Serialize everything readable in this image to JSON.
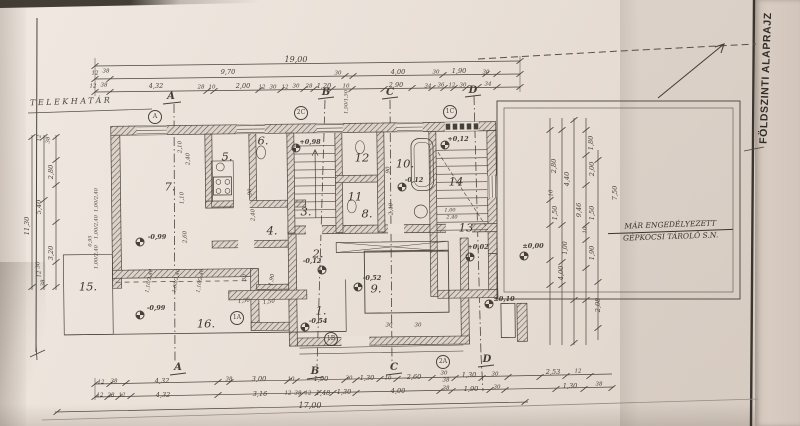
{
  "meta": {
    "sheet_title": "FÖLDSZINTI ALAPRAJZ"
  },
  "site": {
    "boundary_label": "TELEKHATÁR",
    "garage_note_line1": "MÁR ENGEDÉLYEZETT",
    "garage_note_line2": "GÉPKOCSI TÁROLÓ S.N."
  },
  "colors": {
    "paper": "#eae1d9",
    "ink": "#4a443e",
    "binder_strip": "#d8ccc2"
  },
  "rooms": [
    {
      "v": "1.",
      "x": 321,
      "y": 311
    },
    {
      "v": "2.",
      "x": 318,
      "y": 254
    },
    {
      "v": "3.",
      "x": 306,
      "y": 212
    },
    {
      "v": "4.",
      "x": 272,
      "y": 231
    },
    {
      "v": "5.",
      "x": 227,
      "y": 157
    },
    {
      "v": "6.",
      "x": 263,
      "y": 141
    },
    {
      "v": "7.",
      "x": 170,
      "y": 187
    },
    {
      "v": "8.",
      "x": 367,
      "y": 214
    },
    {
      "v": "9.",
      "x": 376,
      "y": 289
    },
    {
      "v": "10.",
      "x": 405,
      "y": 164
    },
    {
      "v": "11",
      "x": 355,
      "y": 197
    },
    {
      "v": "12",
      "x": 362,
      "y": 158
    },
    {
      "v": "13",
      "x": 466,
      "y": 228
    },
    {
      "v": "14",
      "x": 456,
      "y": 182
    },
    {
      "v": "15.",
      "x": 88,
      "y": 287
    },
    {
      "v": "16.",
      "x": 206,
      "y": 324
    }
  ],
  "dimensions": [
    {
      "v": "19,00",
      "x": 296,
      "y": 60,
      "s": 8
    },
    {
      "v": "9,70",
      "x": 228,
      "y": 72
    },
    {
      "v": "4,00",
      "x": 398,
      "y": 72
    },
    {
      "v": "1,90",
      "x": 459,
      "y": 71
    },
    {
      "v": "30",
      "x": 338,
      "y": 74,
      "s": 5.5
    },
    {
      "v": "30",
      "x": 436,
      "y": 73,
      "s": 5.5
    },
    {
      "v": "30",
      "x": 486,
      "y": 73,
      "s": 5.5
    },
    {
      "v": "12",
      "x": 95,
      "y": 74,
      "s": 5.5
    },
    {
      "v": "38",
      "x": 106,
      "y": 72,
      "s": 5.5
    },
    {
      "v": "4,32",
      "x": 156,
      "y": 86
    },
    {
      "v": "28",
      "x": 201,
      "y": 88,
      "s": 5.5
    },
    {
      "v": "10",
      "x": 212,
      "y": 88,
      "s": 5.5
    },
    {
      "v": "2,00",
      "x": 243,
      "y": 86
    },
    {
      "v": "12",
      "x": 262,
      "y": 88,
      "s": 5.5
    },
    {
      "v": "30",
      "x": 273,
      "y": 88,
      "s": 5.5
    },
    {
      "v": "12",
      "x": 285,
      "y": 88,
      "s": 5.5
    },
    {
      "v": "30",
      "x": 296,
      "y": 87,
      "s": 5.5
    },
    {
      "v": "28",
      "x": 309,
      "y": 87,
      "s": 5.5
    },
    {
      "v": "1,20",
      "x": 324,
      "y": 86
    },
    {
      "v": "10",
      "x": 346,
      "y": 87,
      "s": 5.5
    },
    {
      "v": "2,90",
      "x": 396,
      "y": 85
    },
    {
      "v": "34",
      "x": 428,
      "y": 87,
      "s": 5.5
    },
    {
      "v": "36",
      "x": 441,
      "y": 86,
      "s": 5.5
    },
    {
      "v": "12",
      "x": 452,
      "y": 86,
      "s": 5.5
    },
    {
      "v": "30",
      "x": 463,
      "y": 86,
      "s": 5.5
    },
    {
      "v": "34",
      "x": 488,
      "y": 85,
      "s": 5.5
    },
    {
      "v": "12",
      "x": 93,
      "y": 87,
      "s": 5.5
    },
    {
      "v": "38",
      "x": 104,
      "y": 86,
      "s": 5.5
    },
    {
      "v": "11,30",
      "x": 27,
      "y": 226,
      "r": -90
    },
    {
      "v": "5,40",
      "x": 39,
      "y": 207,
      "r": -90
    },
    {
      "v": "2,80",
      "x": 51,
      "y": 172,
      "r": -90
    },
    {
      "v": "3,20",
      "x": 51,
      "y": 253,
      "r": -90
    },
    {
      "v": "12",
      "x": 40,
      "y": 138,
      "r": -90,
      "s": 5.5
    },
    {
      "v": "38",
      "x": 49,
      "y": 140,
      "r": -90,
      "s": 5.5
    },
    {
      "v": "30",
      "x": 39,
      "y": 265,
      "r": -90,
      "s": 5.5
    },
    {
      "v": "12",
      "x": 40,
      "y": 274,
      "r": -90,
      "s": 5.5
    },
    {
      "v": "38",
      "x": 44,
      "y": 283,
      "r": -90,
      "s": 5.5
    },
    {
      "v": "1,00/2,40",
      "x": 97,
      "y": 200,
      "r": -90,
      "s": 5
    },
    {
      "v": "1,00/2,40",
      "x": 97,
      "y": 227,
      "r": -90,
      "s": 5
    },
    {
      "v": "0,95",
      "x": 91,
      "y": 241,
      "r": -90,
      "s": 5
    },
    {
      "v": "1,00/2,40",
      "x": 97,
      "y": 257,
      "r": -90,
      "s": 5
    },
    {
      "v": "1,80",
      "x": 591,
      "y": 143,
      "r": -90
    },
    {
      "v": "2,80",
      "x": 554,
      "y": 166,
      "r": -90
    },
    {
      "v": "4,40",
      "x": 567,
      "y": 179,
      "r": -90
    },
    {
      "v": "2,00",
      "x": 592,
      "y": 169,
      "r": -90
    },
    {
      "v": "10",
      "x": 552,
      "y": 193,
      "r": -90,
      "s": 5.5
    },
    {
      "v": "1,50",
      "x": 555,
      "y": 213,
      "r": -90
    },
    {
      "v": "9,46",
      "x": 579,
      "y": 210,
      "r": -90
    },
    {
      "v": "1,50",
      "x": 592,
      "y": 213,
      "r": -90
    },
    {
      "v": "7,50",
      "x": 615,
      "y": 193,
      "r": -90
    },
    {
      "v": "1,90",
      "x": 592,
      "y": 253,
      "r": -90
    },
    {
      "v": "1,00",
      "x": 566,
      "y": 248,
      "r": -90,
      "s": 6
    },
    {
      "v": "4,00",
      "x": 561,
      "y": 273,
      "r": -90
    },
    {
      "v": "2,08",
      "x": 598,
      "y": 305,
      "r": -90
    },
    {
      "v": "10",
      "x": 586,
      "y": 230,
      "r": -90,
      "s": 5.5
    },
    {
      "v": "12",
      "x": 101,
      "y": 383,
      "s": 5.5
    },
    {
      "v": "38",
      "x": 114,
      "y": 382,
      "s": 5.5
    },
    {
      "v": "4,32",
      "x": 162,
      "y": 381
    },
    {
      "v": "38",
      "x": 229,
      "y": 380,
      "s": 5.5
    },
    {
      "v": "3,00",
      "x": 259,
      "y": 379
    },
    {
      "v": "10",
      "x": 291,
      "y": 380,
      "s": 5.5
    },
    {
      "v": "1,90",
      "x": 321,
      "y": 379
    },
    {
      "v": "30",
      "x": 349,
      "y": 379,
      "s": 5.5
    },
    {
      "v": "1,30",
      "x": 367,
      "y": 378
    },
    {
      "v": "10",
      "x": 388,
      "y": 379,
      "s": 5.5
    },
    {
      "v": "2,60",
      "x": 414,
      "y": 377
    },
    {
      "v": "30",
      "x": 444,
      "y": 374,
      "s": 5.5
    },
    {
      "v": "38",
      "x": 446,
      "y": 381,
      "s": 5.5
    },
    {
      "v": "1,30",
      "x": 469,
      "y": 375
    },
    {
      "v": "30",
      "x": 495,
      "y": 375,
      "s": 5.5
    },
    {
      "v": "2,53",
      "x": 553,
      "y": 372
    },
    {
      "v": "12",
      "x": 578,
      "y": 372,
      "s": 5.5
    },
    {
      "v": "12",
      "x": 100,
      "y": 396,
      "s": 5.5
    },
    {
      "v": "28",
      "x": 111,
      "y": 396,
      "s": 5.5
    },
    {
      "v": "12",
      "x": 122,
      "y": 396,
      "s": 5.5
    },
    {
      "v": "4,32",
      "x": 163,
      "y": 395
    },
    {
      "v": "3,16",
      "x": 260,
      "y": 394
    },
    {
      "v": "12",
      "x": 288,
      "y": 394,
      "s": 5.5
    },
    {
      "v": "38",
      "x": 298,
      "y": 394,
      "s": 5.5
    },
    {
      "v": "12",
      "x": 308,
      "y": 394,
      "s": 5.5
    },
    {
      "v": "1,48",
      "x": 323,
      "y": 393
    },
    {
      "v": "1,30",
      "x": 344,
      "y": 392
    },
    {
      "v": "4,00",
      "x": 398,
      "y": 391
    },
    {
      "v": "38",
      "x": 446,
      "y": 389,
      "s": 5.5
    },
    {
      "v": "1,90",
      "x": 471,
      "y": 389
    },
    {
      "v": "30",
      "x": 497,
      "y": 388,
      "s": 5.5
    },
    {
      "v": "1,30",
      "x": 570,
      "y": 386
    },
    {
      "v": "38",
      "x": 599,
      "y": 385,
      "s": 5.5
    },
    {
      "v": "17,00",
      "x": 310,
      "y": 406,
      "s": 8
    },
    {
      "v": "2,10",
      "x": 181,
      "y": 147,
      "r": -90,
      "s": 5.5
    },
    {
      "v": "2,40",
      "x": 189,
      "y": 159,
      "r": -90,
      "s": 5.5
    },
    {
      "v": "1,10",
      "x": 183,
      "y": 198,
      "r": -90,
      "s": 5.5
    },
    {
      "v": "2,60",
      "x": 186,
      "y": 237,
      "r": -90,
      "s": 5.5
    },
    {
      "v": "90",
      "x": 251,
      "y": 192,
      "r": -90,
      "s": 5.5
    },
    {
      "v": "2,40",
      "x": 254,
      "y": 215,
      "r": -90,
      "s": 5.5
    },
    {
      "v": "90",
      "x": 389,
      "y": 170,
      "r": -90,
      "s": 5.5
    },
    {
      "v": "2,40",
      "x": 392,
      "y": 209,
      "r": -90,
      "s": 5.5
    },
    {
      "v": "1,50/1,50",
      "x": 347,
      "y": 102,
      "r": -90,
      "s": 5
    },
    {
      "v": "1,00",
      "x": 450,
      "y": 211,
      "s": 5
    },
    {
      "v": "2,40",
      "x": 452,
      "y": 218,
      "s": 5
    },
    {
      "v": "30",
      "x": 389,
      "y": 326,
      "s": 5.5
    },
    {
      "v": "30",
      "x": 418,
      "y": 326,
      "s": 5.5
    },
    {
      "v": "1,50",
      "x": 244,
      "y": 302,
      "s": 5.5,
      "r": -8
    },
    {
      "v": "1,50",
      "x": 269,
      "y": 303,
      "s": 5.5,
      "r": -8
    },
    {
      "v": "1,10/2,40",
      "x": 150,
      "y": 281,
      "r": -80,
      "s": 5
    },
    {
      "v": "1,00/2,40",
      "x": 177,
      "y": 281,
      "r": -80,
      "s": 5
    },
    {
      "v": "1,10/2,40",
      "x": 201,
      "y": 281,
      "r": -80,
      "s": 5
    },
    {
      "v": "30",
      "x": 246,
      "y": 278,
      "r": -80,
      "s": 5.5
    },
    {
      "v": "1,90",
      "x": 273,
      "y": 280,
      "r": -80,
      "s": 5.5
    }
  ],
  "elevations": [
    {
      "v": "+0,98",
      "x": 310,
      "y": 142,
      "mx": 296,
      "my": 148
    },
    {
      "v": "+0,12",
      "x": 458,
      "y": 139,
      "mx": 445,
      "my": 145
    },
    {
      "v": "-0,12",
      "x": 414,
      "y": 180,
      "mx": 402,
      "my": 187
    },
    {
      "v": "-0,12",
      "x": 312,
      "y": 261,
      "mx": 322,
      "my": 270
    },
    {
      "v": "-0,52",
      "x": 372,
      "y": 278,
      "mx": 358,
      "my": 287
    },
    {
      "v": "-0,54",
      "x": 318,
      "y": 321,
      "mx": 305,
      "my": 327
    },
    {
      "v": "-0,99",
      "x": 157,
      "y": 237,
      "mx": 140,
      "my": 242
    },
    {
      "v": "-0,99",
      "x": 156,
      "y": 308,
      "mx": 140,
      "my": 315
    },
    {
      "v": "+0,02",
      "x": 478,
      "y": 247,
      "mx": 470,
      "my": 257
    },
    {
      "v": "±0,00",
      "x": 533,
      "y": 246,
      "mx": 524,
      "my": 256
    },
    {
      "v": "±0,10",
      "x": 504,
      "y": 299,
      "mx": 489,
      "my": 304
    }
  ],
  "detail_markers": [
    {
      "v": "A",
      "x": 155,
      "y": 117
    },
    {
      "v": "2C",
      "x": 301,
      "y": 113
    },
    {
      "v": "1C",
      "x": 450,
      "y": 112
    },
    {
      "v": "1A",
      "x": 237,
      "y": 318
    },
    {
      "v": "1B",
      "x": 331,
      "y": 339
    },
    {
      "v": "2A",
      "x": 443,
      "y": 362
    }
  ],
  "section_markers": [
    {
      "v": "A",
      "x": 171,
      "y": 97
    },
    {
      "v": "B",
      "x": 326,
      "y": 93
    },
    {
      "v": "C",
      "x": 390,
      "y": 93
    },
    {
      "v": "D",
      "x": 473,
      "y": 91
    },
    {
      "v": "A",
      "x": 178,
      "y": 368
    },
    {
      "v": "B",
      "x": 315,
      "y": 372
    },
    {
      "v": "C",
      "x": 394,
      "y": 368
    },
    {
      "v": "D",
      "x": 487,
      "y": 360
    }
  ]
}
